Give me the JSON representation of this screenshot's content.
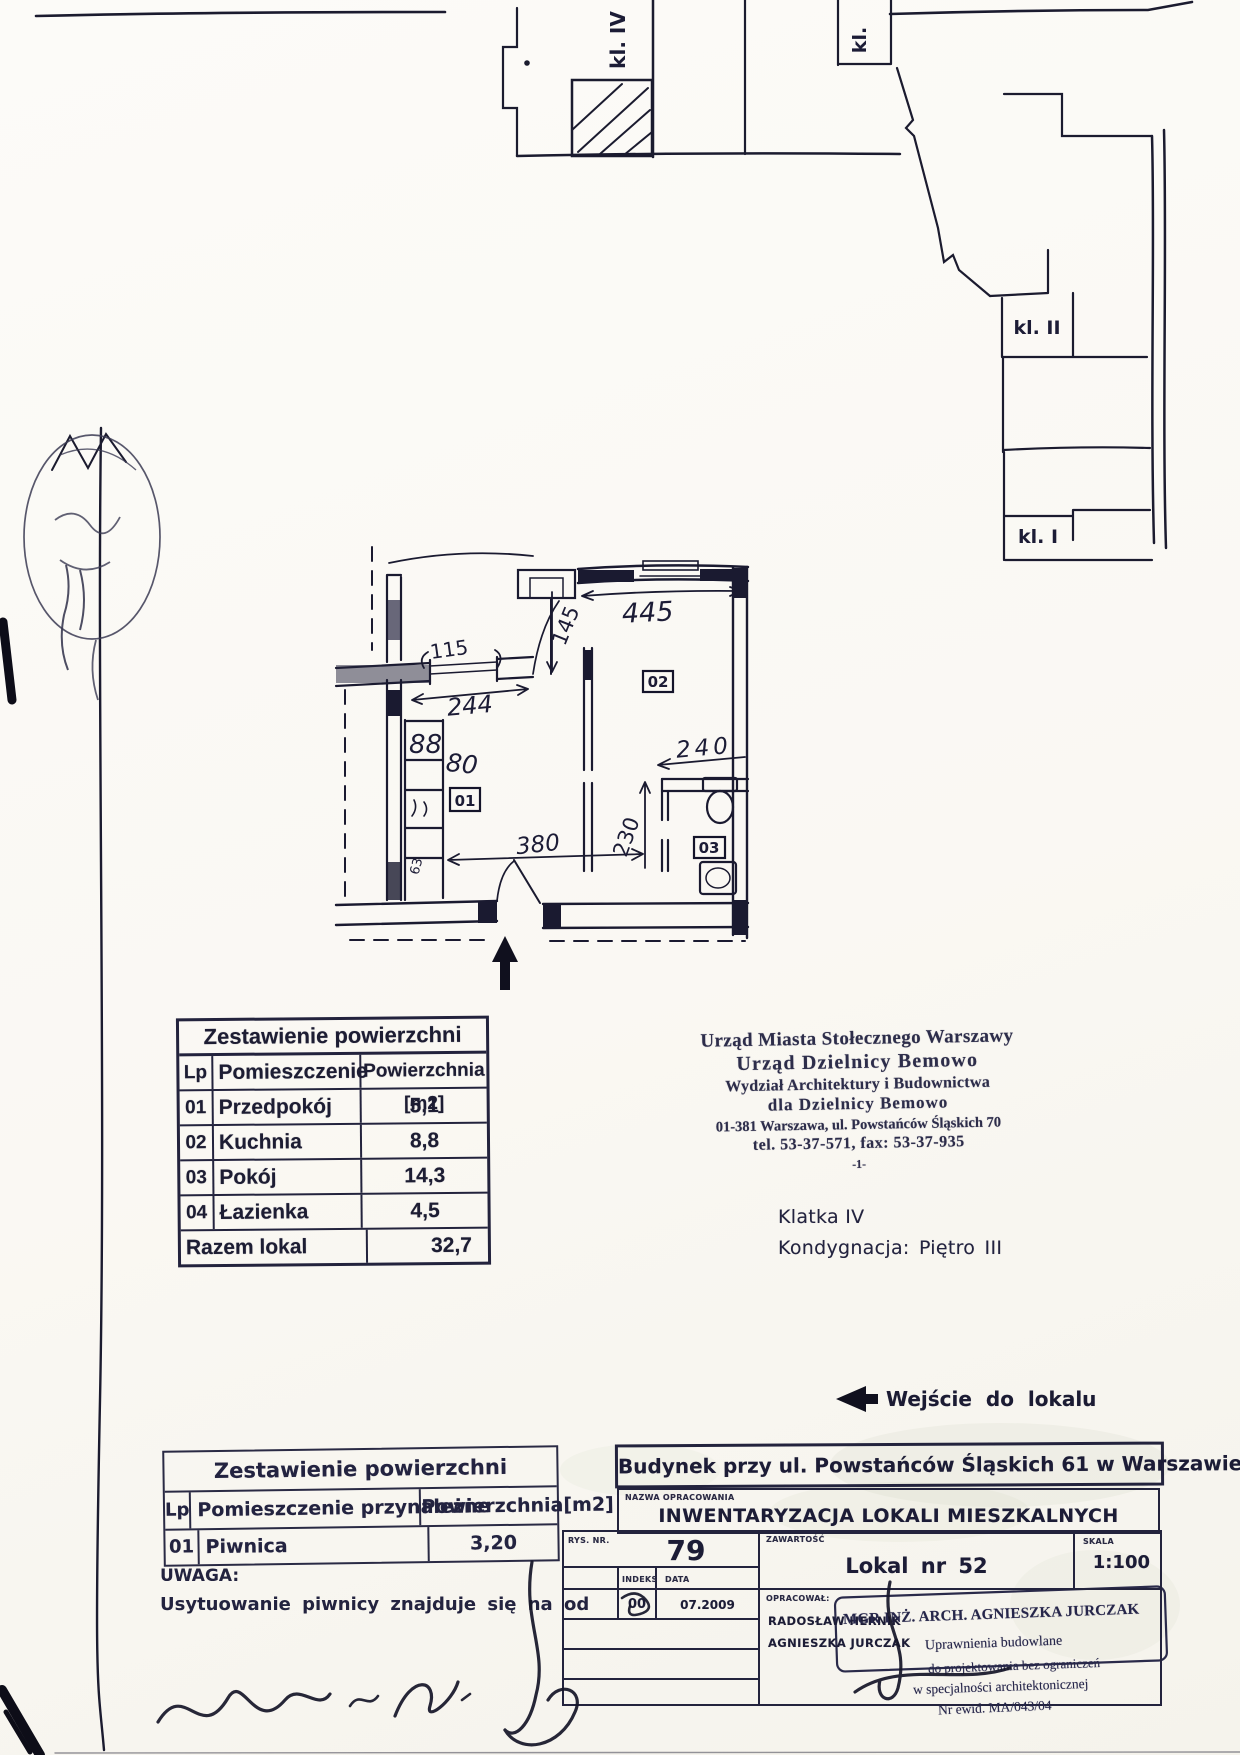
{
  "site_plan": {
    "labels": {
      "kl_iv": "kl. IV",
      "kl_small": "kl.",
      "kl_ii": "kl. II",
      "kl_i": "kl. I"
    }
  },
  "floor_plan": {
    "rooms": {
      "r01": "01",
      "r02": "02",
      "r03": "03"
    },
    "dims": {
      "d445": "445",
      "d115": "115",
      "d145": "145",
      "d244": "244",
      "d88": "88",
      "d80": "80",
      "d240": "240",
      "d230": "230",
      "d380": "380",
      "d63": "63"
    }
  },
  "area_table": {
    "title": "Zestawienie powierzchni",
    "columns": [
      "Lp",
      "Pomieszczenie",
      "Powierzchnia [m2]"
    ],
    "rows": [
      {
        "lp": "01",
        "name": "Przedpokój",
        "area": "5,1"
      },
      {
        "lp": "02",
        "name": "Kuchnia",
        "area": "8,8"
      },
      {
        "lp": "03",
        "name": "Pokój",
        "area": "14,3"
      },
      {
        "lp": "04",
        "name": "Łazienka",
        "area": "4,5"
      }
    ],
    "total_label": "Razem lokal",
    "total_value": "32,7"
  },
  "office_stamp": {
    "line1": "Urząd Miasta Stołecznego Warszawy",
    "line2": "Urząd Dzielnicy Bemowo",
    "line3": "Wydział Architektury i Budownictwa",
    "line4": "dla Dzielnicy Bemowo",
    "line5": "01-381 Warszawa, ul. Powstańców Śląskich 70",
    "line6": "tel. 53-37-571, fax: 53-37-935",
    "line7": "-1-"
  },
  "location": {
    "staircase": "Klatka IV",
    "floor": "Kondygnacja: Piętro III"
  },
  "entrance_label": "Wejście do lokalu",
  "annex_table": {
    "title": "Zestawienie powierzchni",
    "columns": [
      "Lp",
      "Pomieszczenie przynależne",
      "Powierzchnia[m2]"
    ],
    "rows": [
      {
        "lp": "01",
        "name": "Piwnica",
        "area": "3,20"
      }
    ]
  },
  "note": {
    "label": "UWAGA:",
    "text": "Usytuowanie piwnicy znajduje się na odwrocie karty"
  },
  "title_block": {
    "building": "Budynek przy ul. Powstańców Śląskich 61 w Warszawie",
    "name_label": "NAZWA OPRACOWANIA",
    "name": "INWENTARYZACJA LOKALI MIESZKALNYCH",
    "rys_label": "RYS. NR.",
    "rys_no": "79",
    "contents_label": "ZAWARTOŚĆ",
    "contents": "Lokal nr 52",
    "scale_label": "SKALA",
    "scale": "1:100",
    "index_label": "INDEKS",
    "index_value": "00",
    "date_label": "DATA",
    "date_value": "07.2009",
    "prepared_label": "OPRACOWAŁ:",
    "prepared_1": "RADOSŁAW HERNIK",
    "prepared_2": "AGNIESZKA JURCZAK"
  },
  "architect_stamp": {
    "line1": "MGR INŻ. ARCH. AGNIESZKA JURCZAK",
    "line2": "Uprawnienia budowlane",
    "line3": "do projektowania bez ograniczeń",
    "line4": "w specjalności architektonicznej",
    "line5": "Nr ewid. MA/043/04"
  }
}
